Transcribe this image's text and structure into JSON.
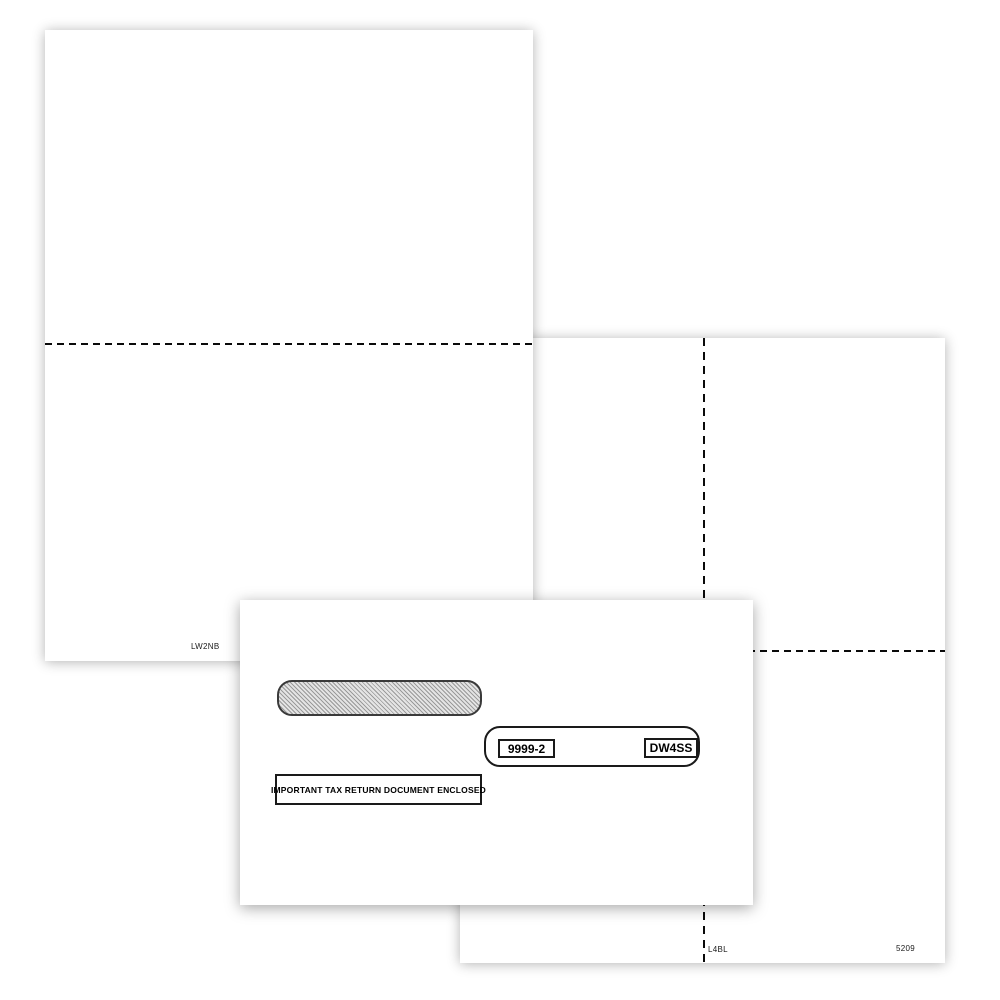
{
  "blank_sheet": {
    "code": "LW2NB"
  },
  "four_up_sheet": {
    "left_code": "L4BL",
    "right_code": "5209"
  },
  "envelope": {
    "form_number": "9999-2",
    "envelope_code": "DW4SS",
    "notice": "IMPORTANT TAX RETURN DOCUMENT ENCLOSED"
  },
  "colors": {
    "background": "#ffffff",
    "paper": "#ffffff",
    "perforation": "#0a0a0a",
    "ink": "#000000",
    "window_hatch_line": "#9a9a9a",
    "window_hatch_bg": "#e4e4e4"
  }
}
